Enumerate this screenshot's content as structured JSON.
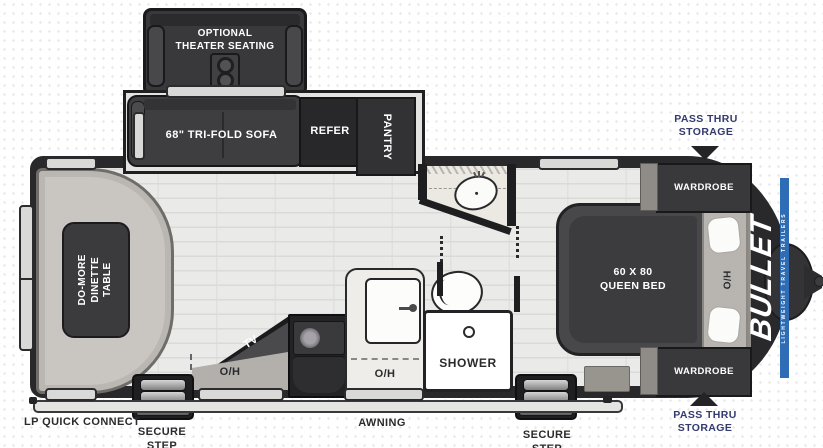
{
  "brand": {
    "name": "BULLET",
    "tagline": "LIGHTWEIGHT TRAVEL TRAILERS",
    "accent_blue": "#2e6cb5"
  },
  "optional": {
    "theater_seating": "OPTIONAL\nTHEATER SEATING"
  },
  "slideout": {
    "sofa": "68\" TRI-FOLD SOFA",
    "refer": "REFER",
    "pantry": "PANTRY"
  },
  "dinette": {
    "table": "DO-MORE\nDINETTE\nTABLE"
  },
  "kitchen": {
    "tv": "TV",
    "overhead_left": "O/H",
    "overhead_right": "O/H"
  },
  "bathroom": {
    "shower": "SHOWER"
  },
  "bedroom": {
    "bed": "60 X 80\nQUEEN BED",
    "head_overhead": "H/O",
    "wardrobe_top": "WARDROBE",
    "wardrobe_bottom": "WARDROBE"
  },
  "exterior": {
    "pass_thru_top": "PASS THRU\nSTORAGE",
    "pass_thru_bottom": "PASS THRU\nSTORAGE",
    "lp_quick_connect": "LP QUICK CONNECT",
    "awning": "AWNING",
    "secure_step_left": "SECURE STEP",
    "secure_step_right": "SECURE STEP"
  },
  "colors": {
    "navy_label": "#333a6e",
    "body_dark": "#29292b",
    "furniture_dark": "#3a3a3c",
    "bench_gray": "#c9c5c1",
    "counter_cream": "#efede9",
    "floor_light": "#eaeae8",
    "accent_blue": "#2e6cb5"
  }
}
